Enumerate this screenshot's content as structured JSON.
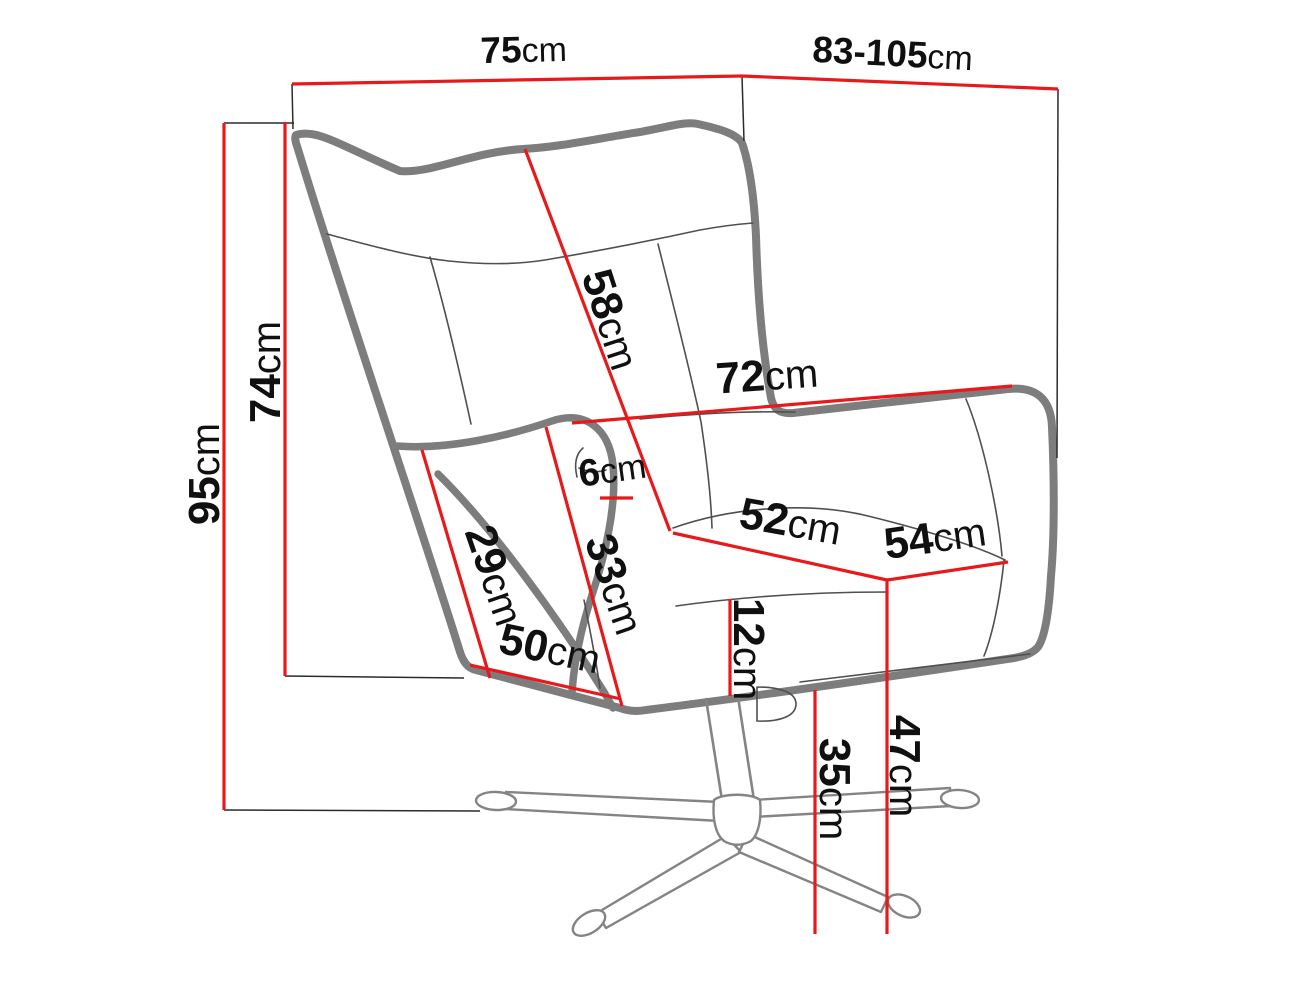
{
  "colors": {
    "background": "#ffffff",
    "dim-red": "#e8191b",
    "outline-gray": "#7d7d7d",
    "seam-gray": "#4f4f4f",
    "base-gray": "#848484",
    "ref-black": "#2b2b2b",
    "ink": "#101010"
  },
  "dims": {
    "overall_width": {
      "value": "75",
      "unit": "cm"
    },
    "overall_depth": {
      "value": "83-105",
      "unit": "cm"
    },
    "overall_height": {
      "value": "95",
      "unit": "cm"
    },
    "backrest_height": {
      "value": "74",
      "unit": "cm"
    },
    "backrest_diagonal": {
      "value": "58",
      "unit": "cm"
    },
    "inner_width": {
      "value": "72",
      "unit": "cm"
    },
    "armrest_front_height": {
      "value": "29",
      "unit": "cm"
    },
    "armrest_inner_height": {
      "value": "33",
      "unit": "cm"
    },
    "armrest_top_width": {
      "value": "6",
      "unit": "cm"
    },
    "seat_width": {
      "value": "52",
      "unit": "cm"
    },
    "seat_depth": {
      "value": "54",
      "unit": "cm"
    },
    "seat_thickness": {
      "value": "12",
      "unit": "cm"
    },
    "base_bottom_width": {
      "value": "50",
      "unit": "cm"
    },
    "underseat_clearance": {
      "value": "35",
      "unit": "cm"
    },
    "seat_height": {
      "value": "47",
      "unit": "cm"
    }
  }
}
